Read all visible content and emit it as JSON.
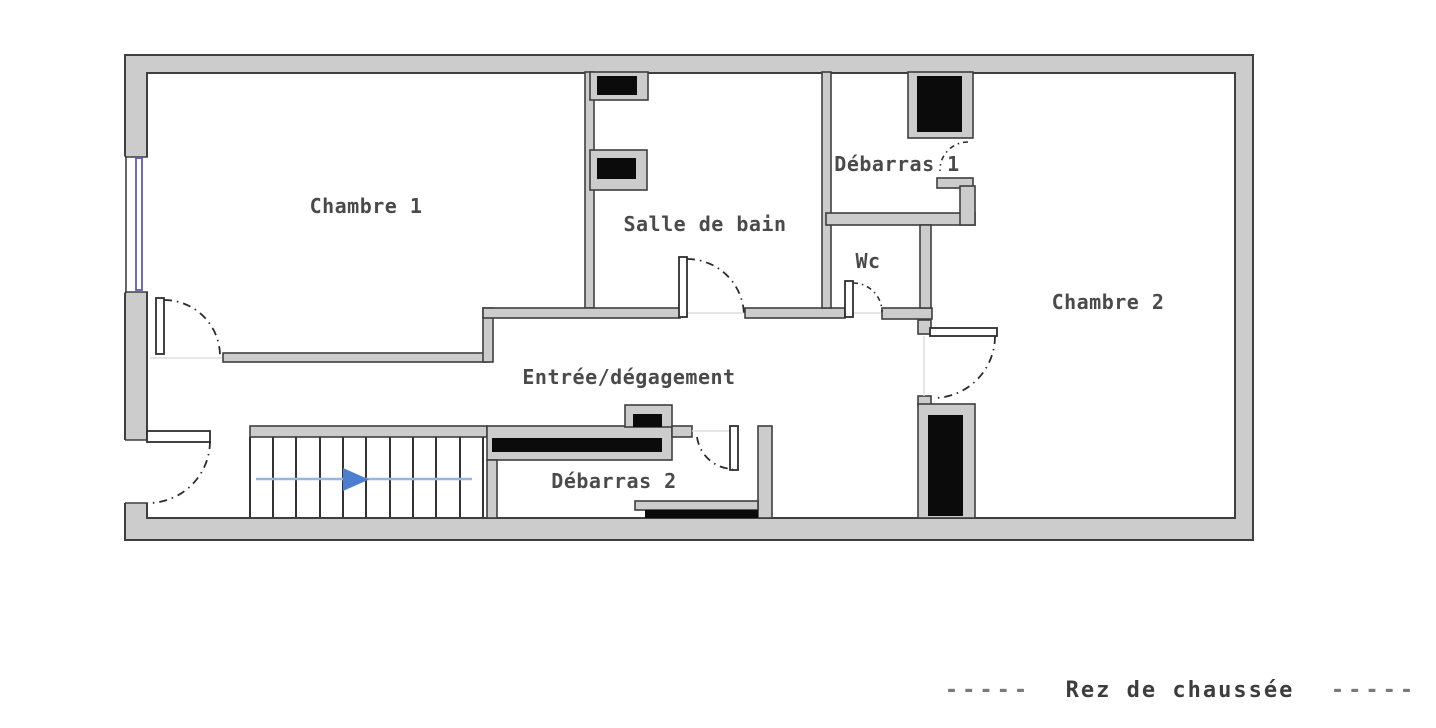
{
  "plan": {
    "rooms": [
      {
        "id": "chambre1",
        "label": "Chambre 1"
      },
      {
        "id": "salle_de_bain",
        "label": "Salle de bain"
      },
      {
        "id": "debarras1",
        "label": "Débarras 1"
      },
      {
        "id": "wc",
        "label": "Wc"
      },
      {
        "id": "chambre2",
        "label": "Chambre 2"
      },
      {
        "id": "entree",
        "label": "Entrée/dégagement"
      },
      {
        "id": "debarras2",
        "label": "Débarras 2"
      }
    ],
    "caption": {
      "left_dashes": "-----",
      "label": "Rez de chaussée",
      "right_dashes": "-----"
    },
    "features": {
      "stairs_step_count": 10,
      "stairs_arrow_direction": "right",
      "window_count": 1,
      "door_count": 7,
      "black_fixture_count": 7
    },
    "colors": {
      "wall_fill": "#cccccc",
      "wall_outline": "#3f3f3f",
      "fixture_black": "#0b0b0b",
      "window_blue": "#5b5bbd",
      "arrow_blue": "#4d7fd0",
      "arrow_line_blue": "#9ab4e0",
      "label_gray": "#4a4a4a",
      "caption_dash_gray": "#7a7a7a"
    }
  }
}
